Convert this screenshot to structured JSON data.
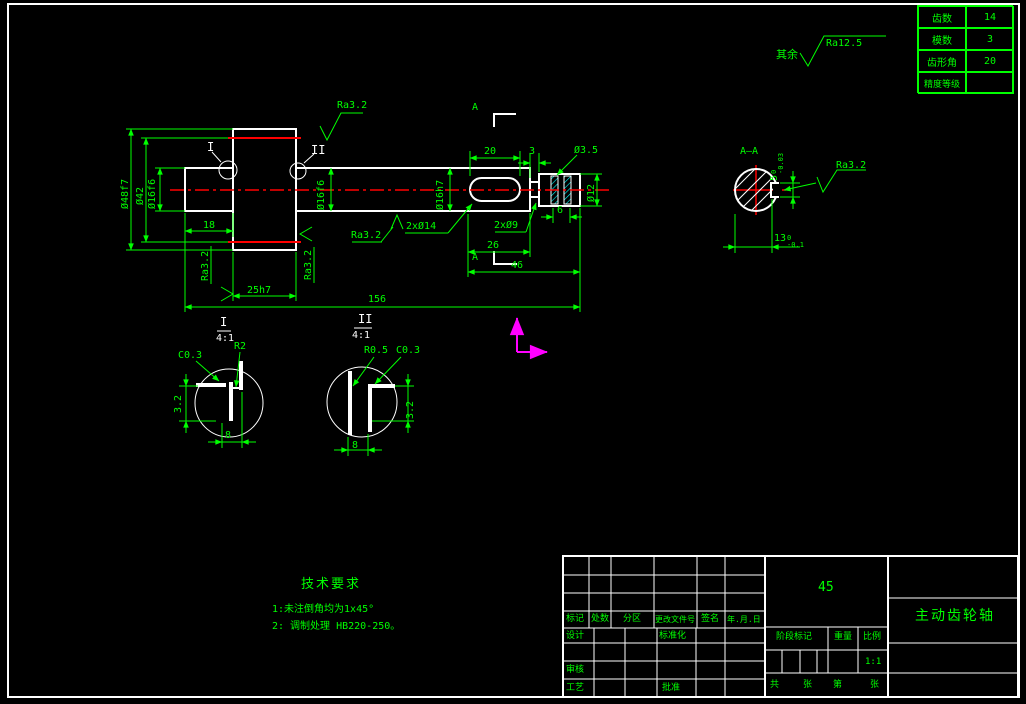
{
  "colors": {
    "background": "#000000",
    "lines": "#ffffff",
    "dimensions": "#00ff00",
    "centerline": "#ff0000",
    "ucs_icon": "#ff00ff",
    "hatch": "#00ffff"
  },
  "gear_table": {
    "rows": [
      {
        "label": "齿数",
        "value": "14"
      },
      {
        "label": "模数",
        "value": "3"
      },
      {
        "label": "齿形角",
        "value": "20"
      },
      {
        "label": "精度等级",
        "value": ""
      }
    ]
  },
  "general_finish": {
    "prefix": "其余",
    "value": "Ra12.5"
  },
  "labels": {
    "detail1": "I",
    "detail2": "II",
    "section_letter": "A",
    "detail_scale": "4:1",
    "section_title": "A—A"
  },
  "dims": {
    "ra": "Ra3.2",
    "dia48": "Ø48f7",
    "dia42": "Ø42",
    "dia16f6_left": "Ø16f6",
    "dia16f6_mid": "Ø16f6",
    "dia16h7": "Ø16h7",
    "dia12": "Ø12",
    "len18": "18",
    "len25": "25h7",
    "len156": "156",
    "len20": "20",
    "len3": "3",
    "len26": "26",
    "len46": "46",
    "len6": "6",
    "note_2x14": "2xØ14",
    "note_2x9": "2xØ9",
    "note_hole": "Ø3.5"
  },
  "section_view": {
    "width": {
      "nominal": "5",
      "upper": "0",
      "lower": "-0.03"
    },
    "offset": {
      "nominal": "13",
      "upper": "0",
      "lower": "-0.1"
    }
  },
  "detail1": {
    "chamfer": "C0.3",
    "radius": "R2",
    "depth": "3.2",
    "width": "8"
  },
  "detail2": {
    "radius": "R0.5",
    "chamfer": "C0.3",
    "depth": "3.2",
    "width": "8"
  },
  "tech_requirements": {
    "title": "技术要求",
    "item1": "1:未注倒角均为1x45°",
    "item2": "2: 调制处理 HB220-250。"
  },
  "title_block": {
    "rev_headers": [
      "标记",
      "处数",
      "分区",
      "更改文件号",
      "签名",
      "年.月.日"
    ],
    "design": "设计",
    "standardize": "标准化",
    "check": "审核",
    "process": "工艺",
    "approve": "批准",
    "material": "45",
    "part_name": "主动齿轮轴",
    "stage_label": "阶段标记",
    "weight_label": "重量",
    "scale_label": "比例",
    "scale_value": "1:1",
    "sheet_total": "共",
    "sheet_unit1": "张",
    "sheet_no": "第",
    "sheet_unit2": "张"
  }
}
